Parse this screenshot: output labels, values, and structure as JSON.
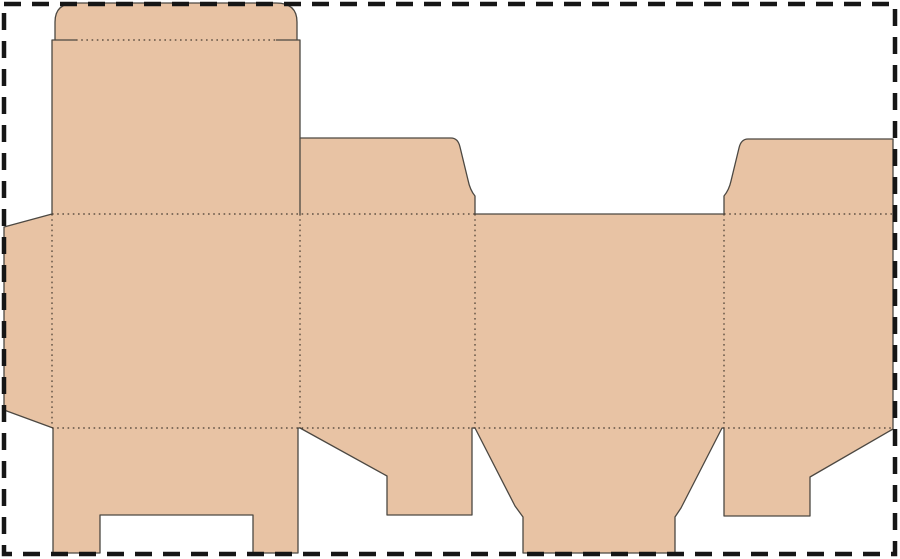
{
  "canvas": {
    "width": 900,
    "height": 559
  },
  "colors": {
    "page_background": "#ffffff",
    "panel_fill": "#e8c3a4",
    "cut_line": "#4c4842",
    "fold_line": "#453b31",
    "border_color": "#161616"
  },
  "dieline": {
    "description": "flat die-cut template of a tuck-end folding carton",
    "outline": "M55,40 L55,22 Q55,3 76,3 L276,3 Q297,3 297,22 L297,40 L300,40 L300,138 L451,138 Q458,138 460,147 L468,180 Q470,190 475,196 L475,214 L724,214 L724,196 Q729,190 731,181 L739,148 Q741,139 748,139 L893,139 L893,429 L810,477 L810,516 L724,516 L724,428 L722,428 L681,508 L675,517 L675,553 L523,553 L523,517 L515,506 L475,428 L472,428 L472,515 L387,515 L387,476 L300,428 L298,428 L298,553 L253,553 L253,515 L100,515 L100,553 L53,553 L53,428 L4,410 L4,227 L52,214 L52,40 Z",
    "cuts": [
      "M300,138 L300,214",
      "M55,40 L76,40",
      "M276,40 L297,40"
    ],
    "folds": [
      "M76,40 L276,40",
      "M52,214 L475,214",
      "M724,214 L893,214",
      "M52,428 L893,428",
      "M52,214 L52,428",
      "M300,214 L300,428",
      "M475,214 L475,428",
      "M724,214 L724,428"
    ],
    "border": {
      "x": 4,
      "y": 4,
      "width": 891,
      "height": 550
    },
    "pieces": [
      "tuck-flap",
      "lid-panel",
      "glue-flap",
      "main-panel-1",
      "main-panel-2",
      "main-panel-3",
      "main-panel-4",
      "top-dust-flap",
      "top-right-flap",
      "bottom-leg-flap",
      "bottom-dust-flap",
      "bottom-center-flap",
      "bottom-right-flap"
    ]
  }
}
